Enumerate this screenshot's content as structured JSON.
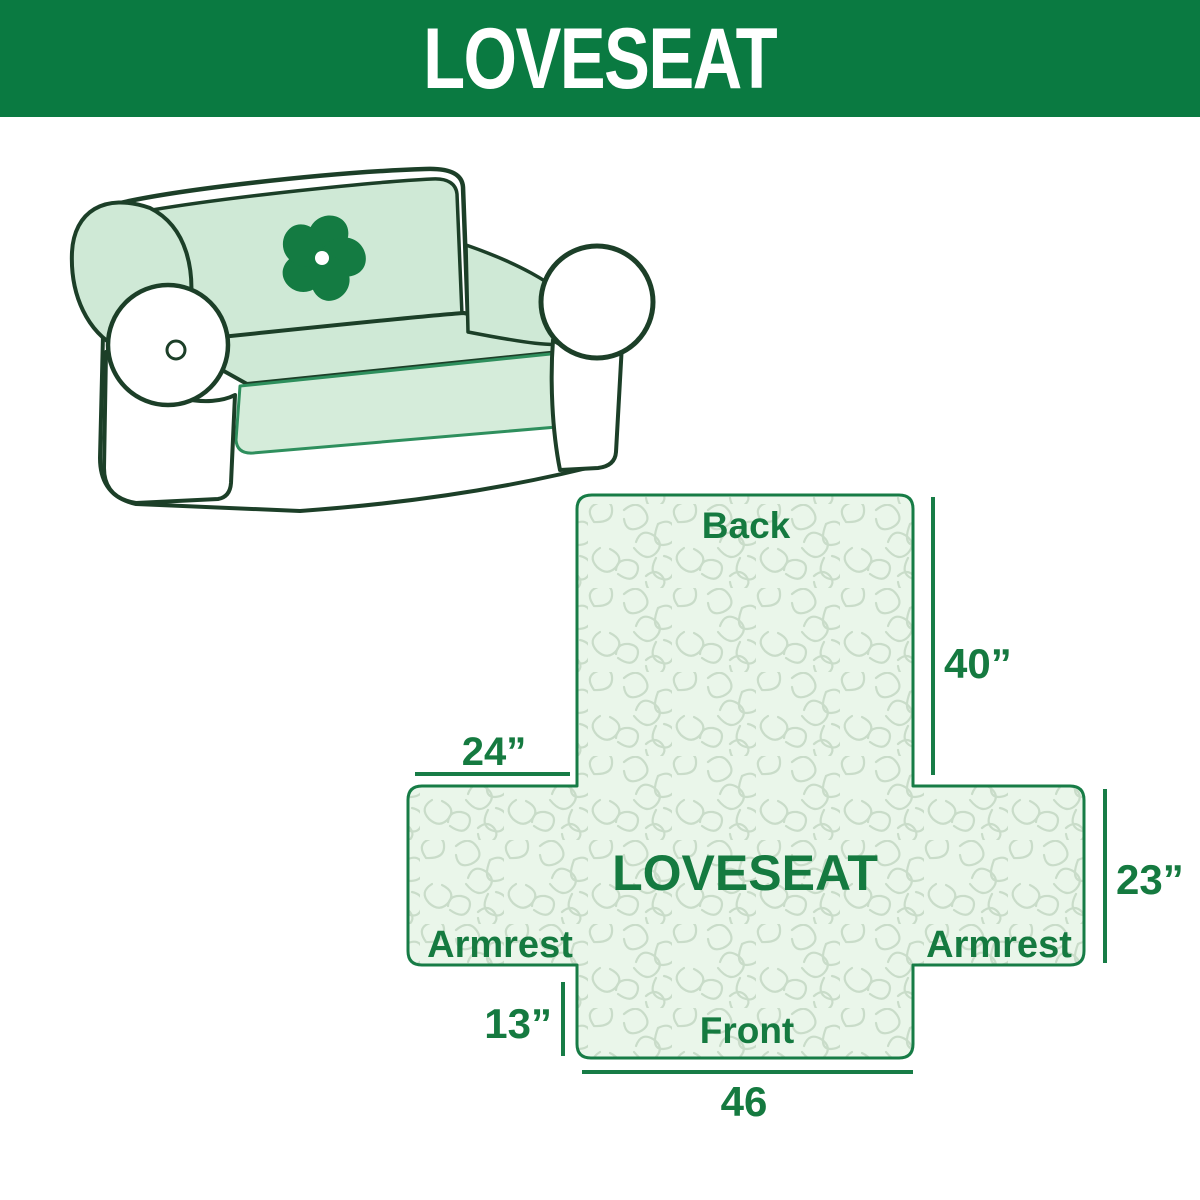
{
  "header": {
    "title": "LOVESEAT"
  },
  "illustration": {
    "description": "line drawing of a two-seat loveseat sofa with a mint green protective cover draped over back, seat and armrest tops",
    "logo_icon": "pinwheel-flower",
    "cover_color": "#cfe9d6",
    "outline_color": "#1c3f28",
    "logo_color": "#147b42"
  },
  "diagram": {
    "center_label": "LOVESEAT",
    "back_label": "Back",
    "front_label": "Front",
    "armrest_left_label": "Armrest",
    "armrest_right_label": "Armrest",
    "dim_back_height": "40”",
    "dim_armrest_width": "24”",
    "dim_armrest_height": "23”",
    "dim_front_drop": "13”",
    "dim_front_width": "46",
    "fill_color": "#eaf6ea",
    "pattern_color": "#c9dcc9",
    "line_color": "#177c46"
  },
  "colors": {
    "banner_green": "#0a7a41",
    "text_green": "#157a40",
    "accent_green": "#177c46",
    "cover_mint": "#cfe9d6",
    "pattern_light": "#c9dcc9",
    "background": "#ffffff"
  }
}
